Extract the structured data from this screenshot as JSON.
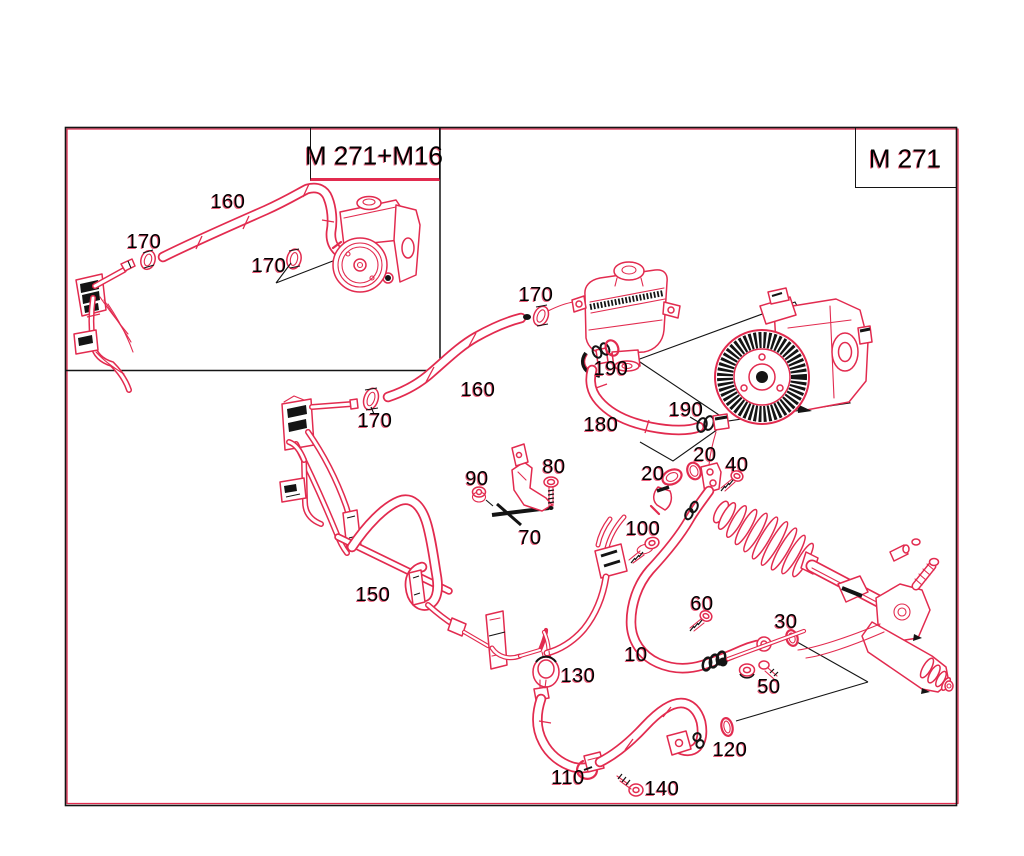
{
  "diagram": {
    "kind": "parts-catalog-line-drawing",
    "subject": "power steering pump, reservoir, hoses and steering gear",
    "colors": {
      "line_red": "#e22b4f",
      "line_black": "#141414",
      "background": "#ffffff"
    },
    "variant_boxes": [
      {
        "id": "inset",
        "label": "M 271+M16",
        "cx": 374,
        "cy": 156
      },
      {
        "id": "main",
        "label": "M 271",
        "cx": 905,
        "cy": 159
      }
    ],
    "part_labels": [
      {
        "text": "160",
        "area": "inset",
        "x": 228,
        "y": 203
      },
      {
        "text": "170",
        "area": "inset",
        "x": 144,
        "y": 243
      },
      {
        "text": "170",
        "area": "inset",
        "x": 269,
        "y": 267
      },
      {
        "text": "170",
        "area": "main",
        "x": 536,
        "y": 296
      },
      {
        "text": "160",
        "area": "main",
        "x": 478,
        "y": 391
      },
      {
        "text": "170",
        "area": "main",
        "x": 375,
        "y": 422
      },
      {
        "text": "190",
        "area": "main",
        "x": 611,
        "y": 370
      },
      {
        "text": "180",
        "area": "main",
        "x": 601,
        "y": 426
      },
      {
        "text": "190",
        "area": "main",
        "x": 686,
        "y": 411
      },
      {
        "text": "20",
        "area": "main",
        "x": 705,
        "y": 456
      },
      {
        "text": "40",
        "area": "main",
        "x": 737,
        "y": 466
      },
      {
        "text": "20",
        "area": "main",
        "x": 653,
        "y": 475
      },
      {
        "text": "90",
        "area": "main",
        "x": 477,
        "y": 480
      },
      {
        "text": "80",
        "area": "main",
        "x": 554,
        "y": 468
      },
      {
        "text": "70",
        "area": "main",
        "x": 530,
        "y": 539
      },
      {
        "text": "100",
        "area": "main",
        "x": 643,
        "y": 530
      },
      {
        "text": "150",
        "area": "main",
        "x": 373,
        "y": 596
      },
      {
        "text": "60",
        "area": "main",
        "x": 702,
        "y": 605
      },
      {
        "text": "10",
        "area": "main",
        "x": 636,
        "y": 656
      },
      {
        "text": "30",
        "area": "main",
        "x": 786,
        "y": 623
      },
      {
        "text": "50",
        "area": "main",
        "x": 769,
        "y": 688
      },
      {
        "text": "130",
        "area": "main",
        "x": 578,
        "y": 677
      },
      {
        "text": "120",
        "area": "main",
        "x": 730,
        "y": 751
      },
      {
        "text": "110",
        "area": "main",
        "x": 568,
        "y": 779
      },
      {
        "text": "140",
        "area": "main",
        "x": 662,
        "y": 790
      }
    ]
  }
}
